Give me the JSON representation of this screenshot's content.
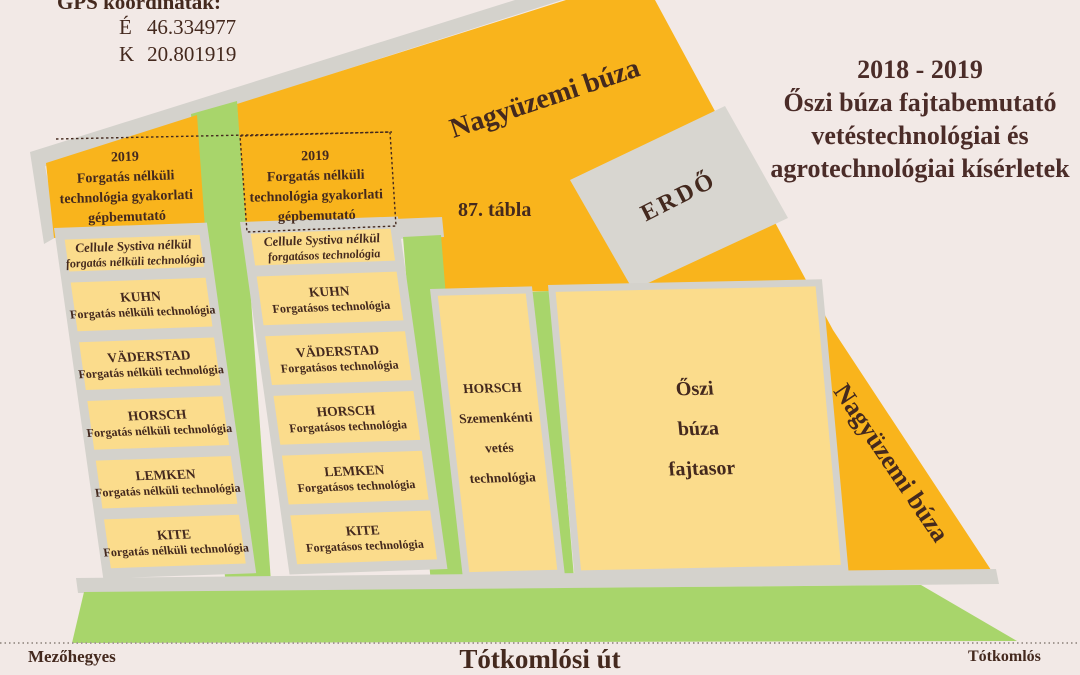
{
  "gps": {
    "title": "GPS koordináták:",
    "north_label": "É",
    "north": "46.334977",
    "east_label": "K",
    "east": "20.801919"
  },
  "title": {
    "lines": [
      "2018 - 2019",
      "Őszi búza fajtabemutató",
      "vetéstechnológiai és",
      "agrotechnológiai kísérletek"
    ]
  },
  "field": {
    "top_wheat": "Nagyüzemi búza",
    "plot_number": "87. tábla",
    "forest": "ERDŐ",
    "right_wheat": "Nagyüzemi búza"
  },
  "columns": [
    {
      "header": {
        "lines": [
          "2019",
          "Forgatás nélküli",
          "technológia gyakorlati",
          "gépbemutató"
        ]
      },
      "rows": [
        {
          "name": "Cellule Systiva nélkül",
          "tech": "forgatás nélküli technológia"
        },
        {
          "name": "KUHN",
          "tech": "Forgatás nélküli technológia"
        },
        {
          "name": "VÄDERSTAD",
          "tech": "Forgatás nélküli technológia"
        },
        {
          "name": "HORSCH",
          "tech": "Forgatás nélküli technológia"
        },
        {
          "name": "LEMKEN",
          "tech": "Forgatás nélküli technológia"
        },
        {
          "name": "KITE",
          "tech": "Forgatás nélküli technológia"
        }
      ]
    },
    {
      "header": {
        "lines": [
          "2019",
          "Forgatás nélküli",
          "technológia gyakorlati",
          "gépbemutató"
        ]
      },
      "rows": [
        {
          "name": "Cellule Systiva nélkül",
          "tech": "forgatásos technológia"
        },
        {
          "name": "KUHN",
          "tech": "Forgatásos technológia"
        },
        {
          "name": "VÄDERSTAD",
          "tech": "Forgatásos technológia"
        },
        {
          "name": "HORSCH",
          "tech": "Forgatásos technológia"
        },
        {
          "name": "LEMKEN",
          "tech": "Forgatásos technológia"
        },
        {
          "name": "KITE",
          "tech": "Forgatásos technológia"
        }
      ]
    }
  ],
  "blocks": {
    "seed": {
      "lines": [
        "HORSCH",
        "Szemenkénti",
        "vetés",
        "technológia"
      ]
    },
    "variety": {
      "lines": [
        "Őszi",
        "búza",
        "fajtasor"
      ]
    }
  },
  "road": {
    "name": "Tótkomlósi út",
    "left_city": "Mezőhegyes",
    "right_city": "Tótkomlós"
  },
  "colors": {
    "background": "#f2e9e6",
    "orange": "#f9b41c",
    "yellow": "#fbdc8c",
    "green": "#a8d56b",
    "gray": "#d4d2cc",
    "text": "#44291e"
  }
}
